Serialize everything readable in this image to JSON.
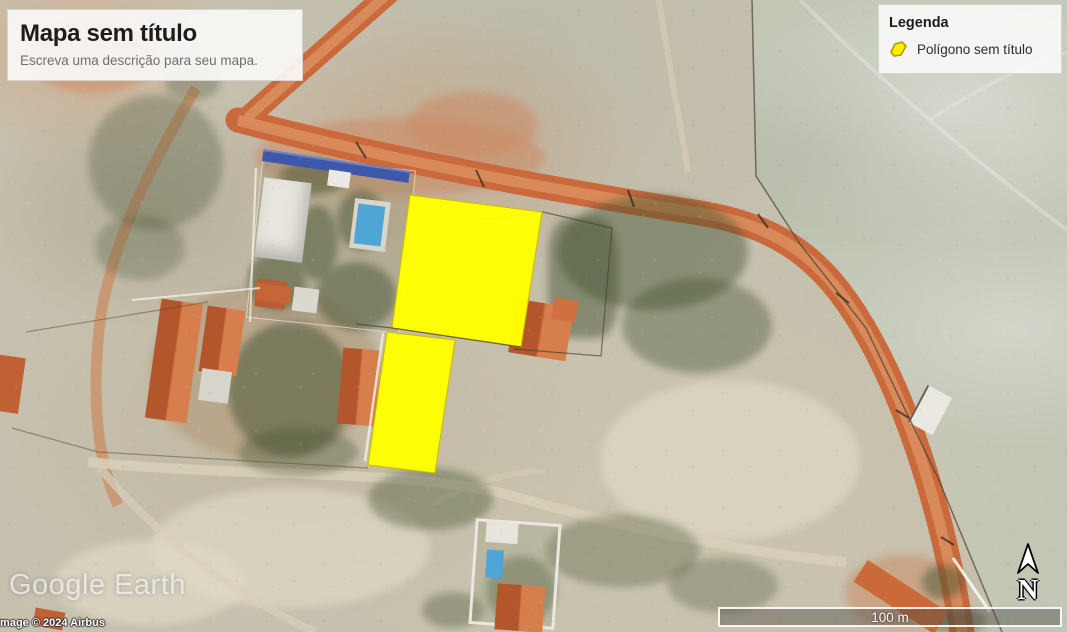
{
  "title_box": {
    "title": "Mapa sem título",
    "description": "Escreva uma descrição para seu mapa."
  },
  "legend": {
    "title": "Legenda",
    "items": [
      {
        "icon": "polygon-icon",
        "label": "Polígono sem título",
        "color": "#ffff00"
      }
    ]
  },
  "overlay": {
    "polygon_fill": "#ffff00",
    "polygon_stroke": "#cdb900",
    "polygons": [
      {
        "name": "Polígono sem título",
        "points": "410,195 542,212 521,347 392,328"
      },
      {
        "name": "Polígono sem título",
        "points": "387,332 455,340 435,473 368,465"
      }
    ]
  },
  "watermark": {
    "logo": "Google Earth",
    "copyright": "Image © 2024 Airbus"
  },
  "scale_bar": {
    "label": "100 m"
  },
  "north_indicator": {
    "label": "N"
  },
  "map_colors": {
    "dirt_road": "#c9693c",
    "roof": "#c4602f",
    "pool": "#4fa6d6",
    "pasture": "#c1c6b5"
  }
}
